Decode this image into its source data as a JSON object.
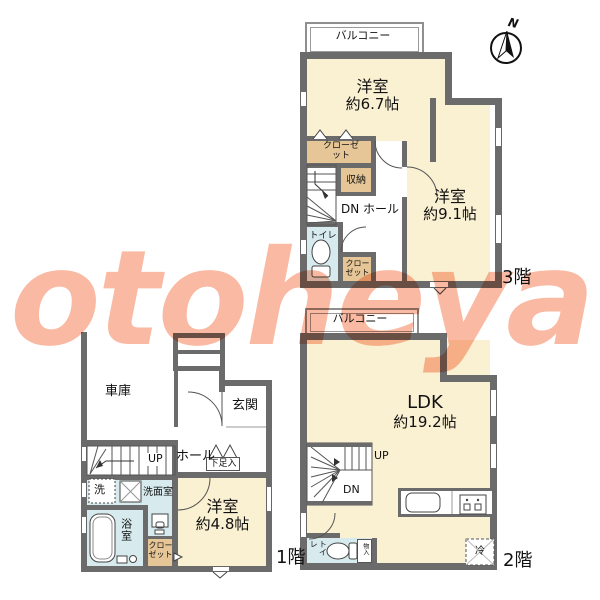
{
  "watermark": "otoheya",
  "compass": {
    "north_label": "N"
  },
  "floor3": {
    "name_label": "3階",
    "balcony_label": "バルコニー",
    "room1_name": "洋室",
    "room1_size": "約6.7帖",
    "room2_name": "洋室",
    "room2_size": "約9.1帖",
    "closet_top_label": "クローゼット",
    "storage_label": "収納",
    "hall_label": "DN ホール",
    "toilet_label": "トイレ",
    "closet_bottom_label": "クローゼット"
  },
  "floor2": {
    "name_label": "2階",
    "balcony_label": "バルコニー",
    "ldk_name": "LDK",
    "ldk_size": "約19.2帖",
    "up_label": "UP",
    "dn_label": "DN",
    "toilet_label": "トイレ",
    "storage_strip_label": "物入",
    "fridge_label": "冷"
  },
  "floor1": {
    "name_label": "1階",
    "garage_label": "車庫",
    "entrance_label": "玄関",
    "hall_label": "ホール",
    "up_label": "UP",
    "shoebox_label": "下足入",
    "washer_label": "洗",
    "washroom_label": "洗面室",
    "bathroom_label": "浴室",
    "closet_label": "クローゼット",
    "room_name": "洋室",
    "room_size": "約4.8帖"
  }
}
